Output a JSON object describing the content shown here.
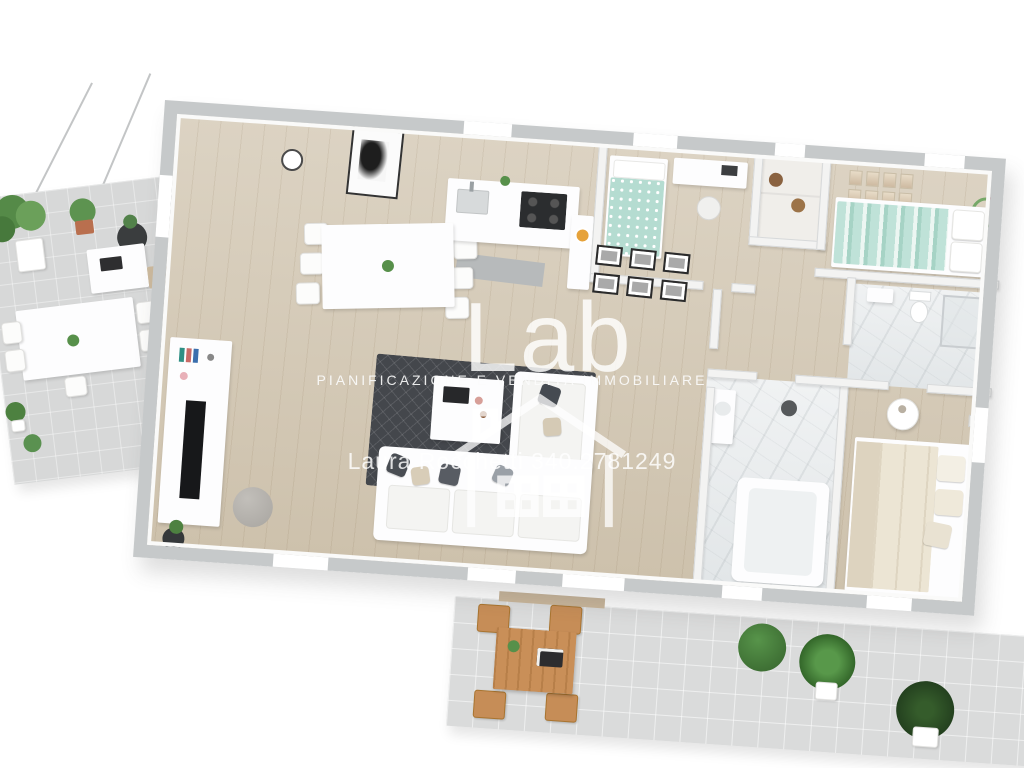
{
  "watermark": {
    "logo_text": "Lab",
    "tagline": "PIANIFICAZIONE E VENDITA IMMOBILIARE",
    "contact": "Laura Rocchetti 340.2781249",
    "text_color": "#ffffff"
  },
  "icons": {
    "house_icon": "house-outline"
  },
  "palette": {
    "background": "#ffffff",
    "wall_cap": "#c6c9ca",
    "wall_face": "#f3f3f2",
    "wood_floor": "#d5cab6",
    "terrace_floor": "#d7d8d8",
    "patio_floor": "#dadbdb",
    "dark_rug": "#44474c",
    "teal_bedding": "#b5dcd1",
    "cream_bedding": "#ece5d4",
    "marble": "#eef0f1",
    "outdoor_wood": "#c98f58",
    "plant_green": "#57904a"
  },
  "scene": {
    "type": "3d-floor-plan-render",
    "rooms": [
      "terrace",
      "living-room",
      "dining-area",
      "kitchen",
      "hallway",
      "kids-bedroom",
      "double-bedroom",
      "bathroom",
      "master-bathroom",
      "master-bedroom",
      "patio"
    ]
  }
}
